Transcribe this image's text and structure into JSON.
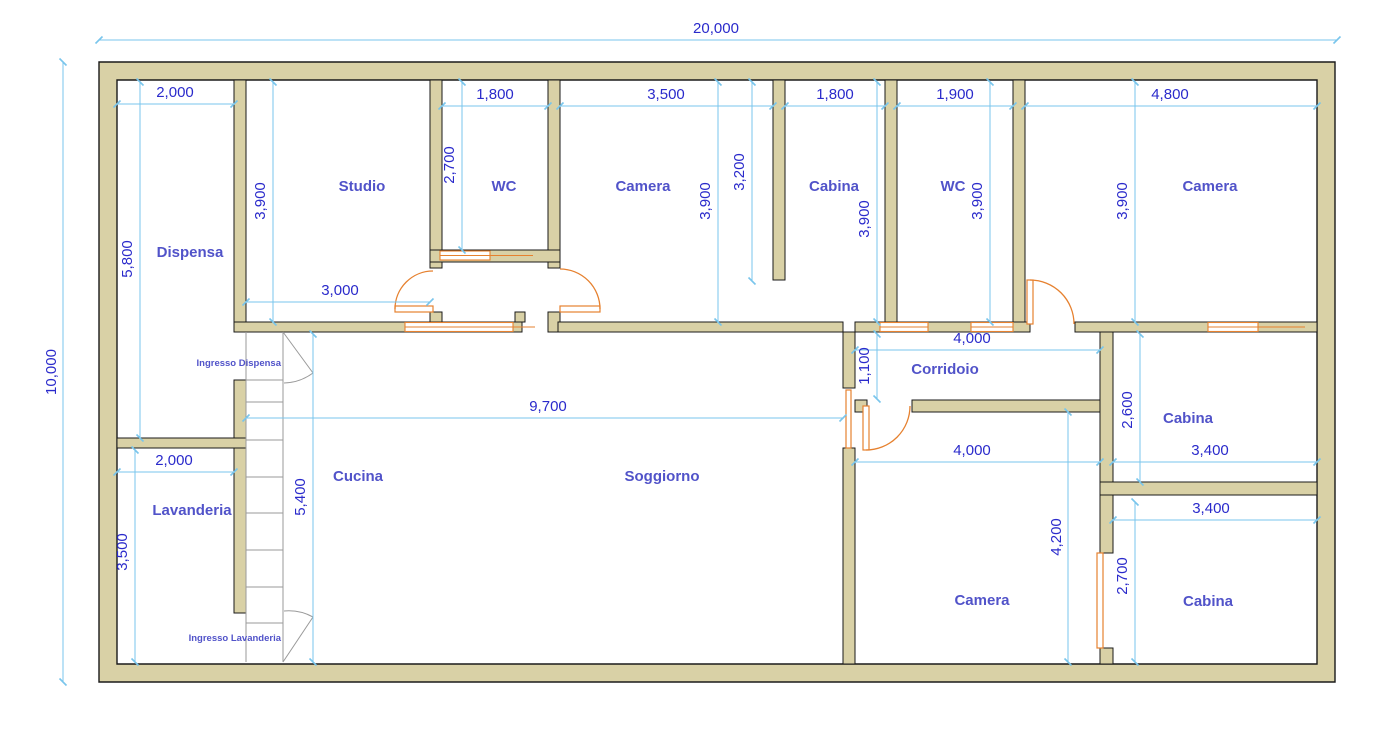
{
  "colors": {
    "background": "#ffffff",
    "wall_fill": "#d9d1a6",
    "wall_outline": "#1a1a1a",
    "dimension_line": "#79c5ec",
    "dimension_text": "#2a2acb",
    "room_label": "#5153c9",
    "door": "#e6812f",
    "stair": "#9a9a9a"
  },
  "plan": {
    "rooms": [
      {
        "id": "dispensa",
        "label": "Dispensa"
      },
      {
        "id": "studio",
        "label": "Studio"
      },
      {
        "id": "wc-1",
        "label": "WC"
      },
      {
        "id": "camera-1",
        "label": "Camera"
      },
      {
        "id": "cabina-1",
        "label": "Cabina"
      },
      {
        "id": "wc-2",
        "label": "WC"
      },
      {
        "id": "camera-2",
        "label": "Camera"
      },
      {
        "id": "corridoio",
        "label": "Corridoio"
      },
      {
        "id": "cabina-2",
        "label": "Cabina"
      },
      {
        "id": "cucina",
        "label": "Cucina"
      },
      {
        "id": "soggiorno",
        "label": "Soggiorno"
      },
      {
        "id": "camera-3",
        "label": "Camera"
      },
      {
        "id": "cabina-3",
        "label": "Cabina"
      },
      {
        "id": "lavanderia",
        "label": "Lavanderia"
      }
    ],
    "entrances": [
      {
        "id": "ingresso-dispensa",
        "label": "Ingresso Dispensa"
      },
      {
        "id": "ingresso-lavanderia",
        "label": "Ingresso Lavanderia"
      }
    ],
    "dimensions": [
      {
        "id": "overall-width",
        "value": "20,000"
      },
      {
        "id": "overall-height",
        "value": "10,000"
      },
      {
        "id": "dispensa-width",
        "value": "2,000"
      },
      {
        "id": "wc1-width",
        "value": "1,800"
      },
      {
        "id": "camera1-width",
        "value": "3,500"
      },
      {
        "id": "cabina1-width",
        "value": "1,800"
      },
      {
        "id": "wc2-width",
        "value": "1,900"
      },
      {
        "id": "camera2-width",
        "value": "4,800"
      },
      {
        "id": "dispensa-height",
        "value": "5,800"
      },
      {
        "id": "studio-height",
        "value": "3,900"
      },
      {
        "id": "wc1-height",
        "value": "2,700"
      },
      {
        "id": "camera1-height",
        "value": "3,900"
      },
      {
        "id": "divider-wall-length",
        "value": "3,200"
      },
      {
        "id": "cabina1-height",
        "value": "3,900"
      },
      {
        "id": "wc2-height",
        "value": "3,900"
      },
      {
        "id": "camera2-height",
        "value": "3,900"
      },
      {
        "id": "studio-width",
        "value": "3,000"
      },
      {
        "id": "soggiorno-width",
        "value": "9,700"
      },
      {
        "id": "lavanderia-width",
        "value": "2,000"
      },
      {
        "id": "lavanderia-height",
        "value": "3,500"
      },
      {
        "id": "cucina-height",
        "value": "5,400"
      },
      {
        "id": "corridoio-length",
        "value": "4,000"
      },
      {
        "id": "corridoio-width",
        "value": "1,100"
      },
      {
        "id": "cabina2-width",
        "value": "3,400"
      },
      {
        "id": "cabina2-height",
        "value": "2,600"
      },
      {
        "id": "camera3-width",
        "value": "4,000"
      },
      {
        "id": "camera3-height",
        "value": "4,200"
      },
      {
        "id": "cabina3-width",
        "value": "3,400"
      },
      {
        "id": "cabina3-height",
        "value": "2,700"
      }
    ]
  }
}
